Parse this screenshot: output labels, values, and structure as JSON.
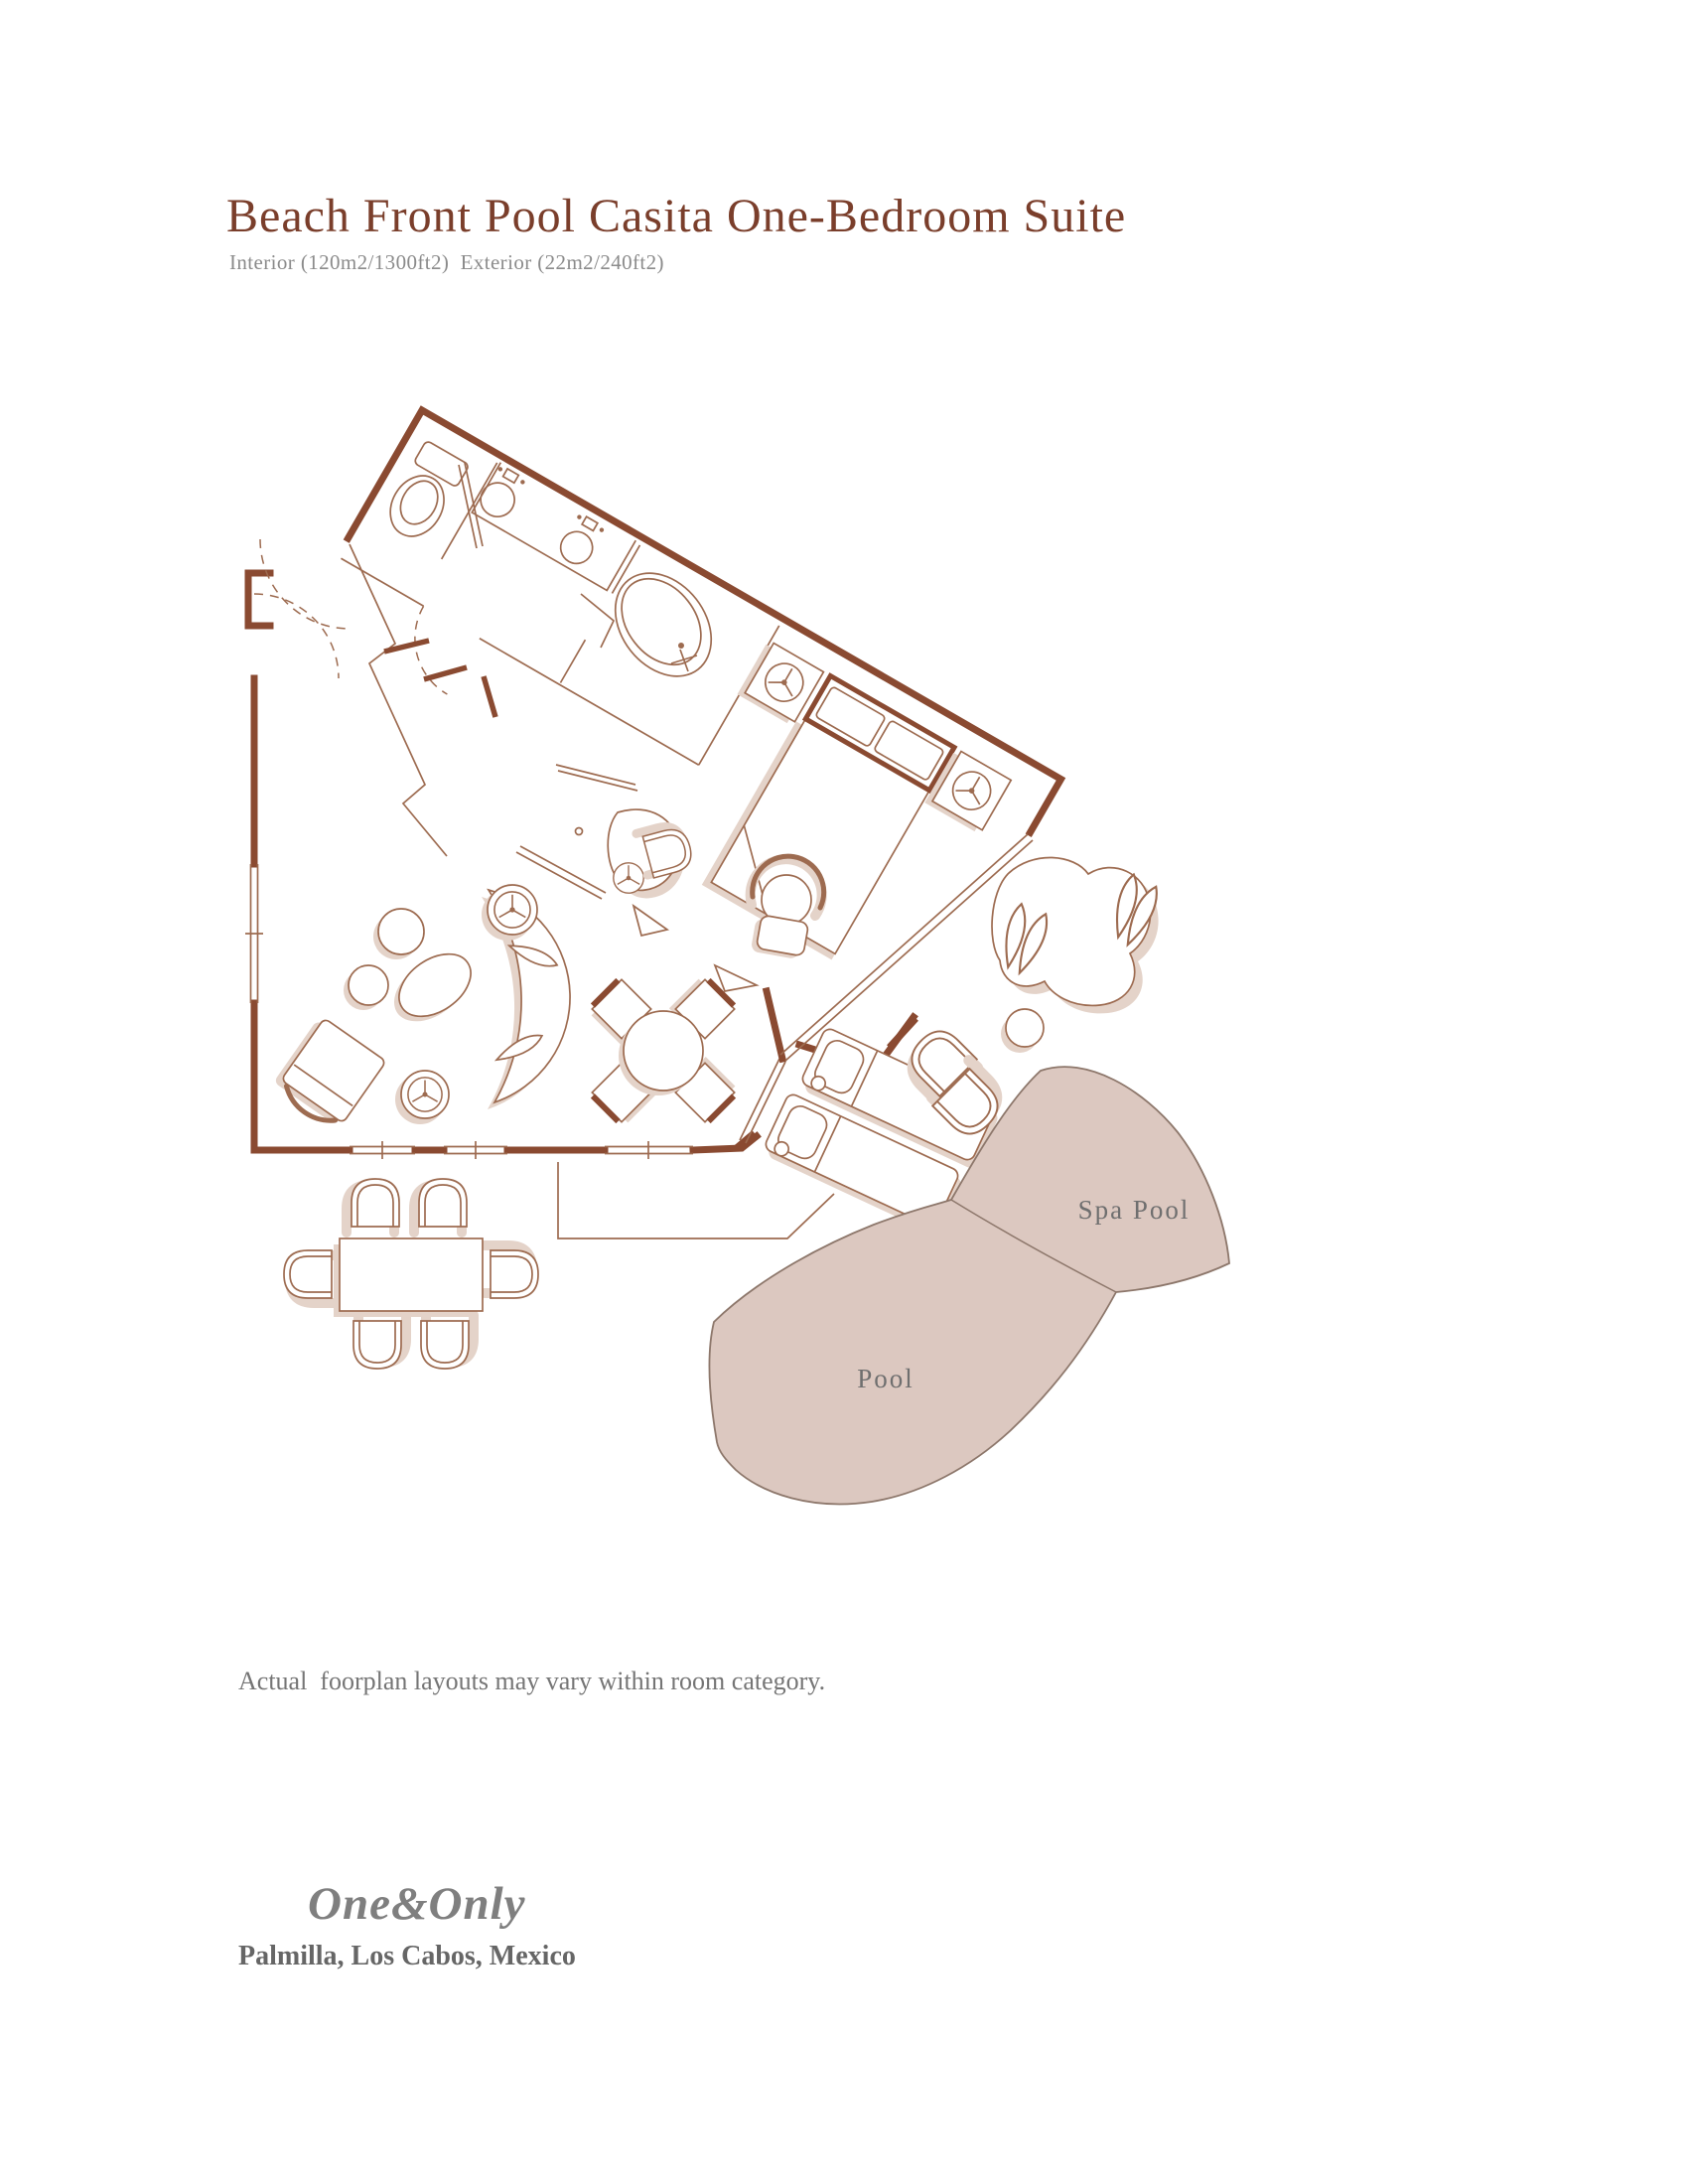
{
  "header": {
    "title": "Beach Front Pool Casita One-Bedroom Suite",
    "subtitle": "Interior (120m2/1300ft2)  Exterior (22m2/240ft2)"
  },
  "plan": {
    "labels": {
      "spa_pool": "Spa Pool",
      "pool": "Pool"
    }
  },
  "footer": {
    "disclaimer": "Actual  foorplan layouts may vary within room category.",
    "logo": "One&Only",
    "location": "Palmilla, Los Cabos, Mexico"
  },
  "colors": {
    "title_brown": "#7a3e2b",
    "wall_brown": "#8a4a31",
    "line_brown": "#9d6b50",
    "shadow_tan": "#e4d3c9",
    "pool_fill": "#dcc8c0",
    "pool_stroke": "#8d776b",
    "subtitle_gray": "#8b8b8b",
    "disclaimer_gray": "#757575",
    "logo_gray": "#7f7f7f",
    "location_gray": "#666666",
    "plan_label_gray": "#6f6f6f"
  }
}
